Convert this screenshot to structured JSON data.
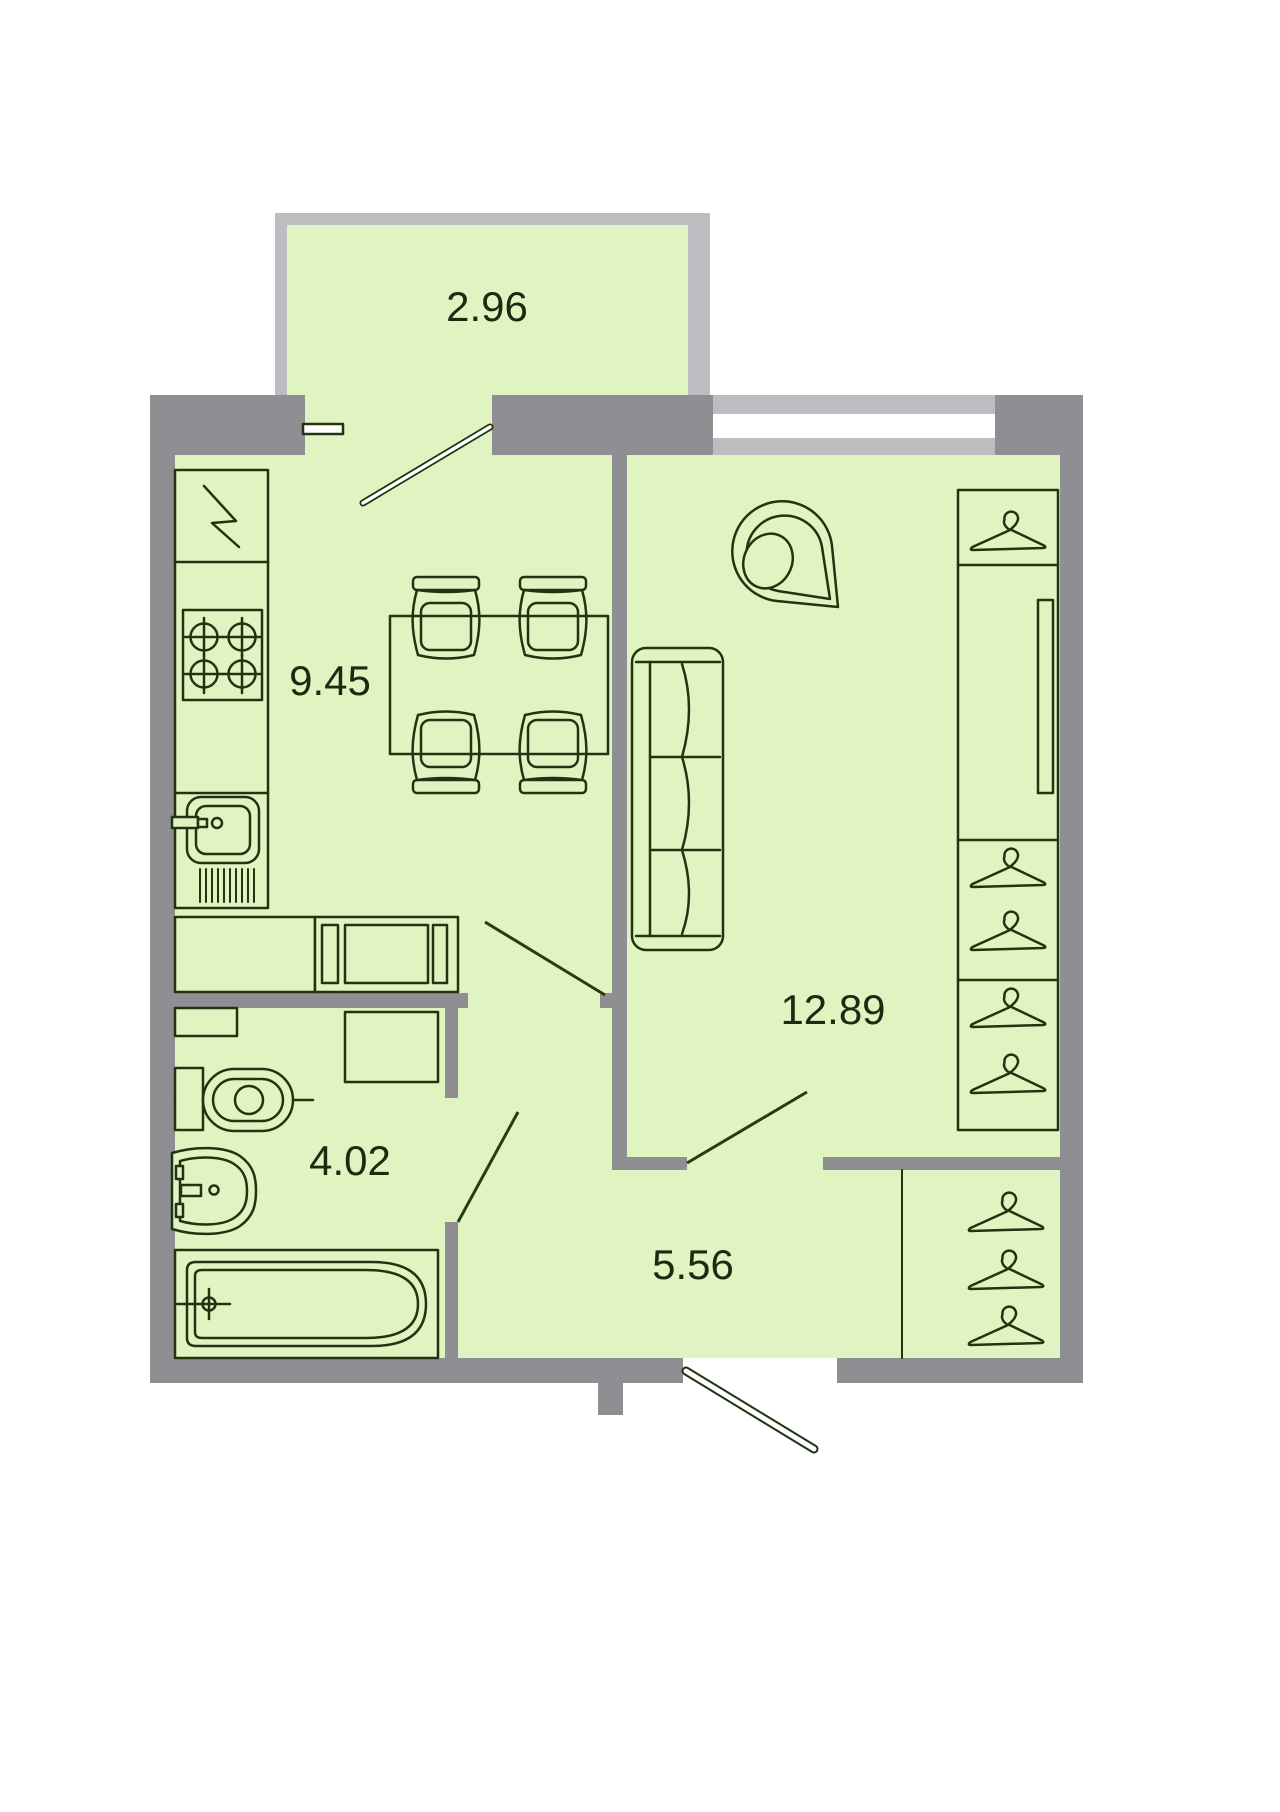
{
  "plan": {
    "rooms": [
      {
        "id": "balcony",
        "area": "2.96"
      },
      {
        "id": "kitchen-dining",
        "area": "9.45"
      },
      {
        "id": "living-room",
        "area": "12.89"
      },
      {
        "id": "bathroom",
        "area": "4.02"
      },
      {
        "id": "hallway",
        "area": "5.56"
      }
    ],
    "colors": {
      "wall": "#8f8f93",
      "window_frame": "#bdbdc1",
      "floor": "#e0f4c2",
      "outline": "#223312",
      "label": "#1c2a10",
      "glass": "#ffffff",
      "background": "#ffffff"
    },
    "fixtures": [
      "fridge",
      "stove",
      "kitchen-sink",
      "dining-table",
      "chair",
      "sofa",
      "armchair",
      "wardrobe",
      "clothes-rod",
      "hanger",
      "toilet",
      "washing-machine",
      "wash-basin",
      "bathtub",
      "bench",
      "hallway-closet",
      "balcony-door",
      "entrance-door"
    ]
  }
}
